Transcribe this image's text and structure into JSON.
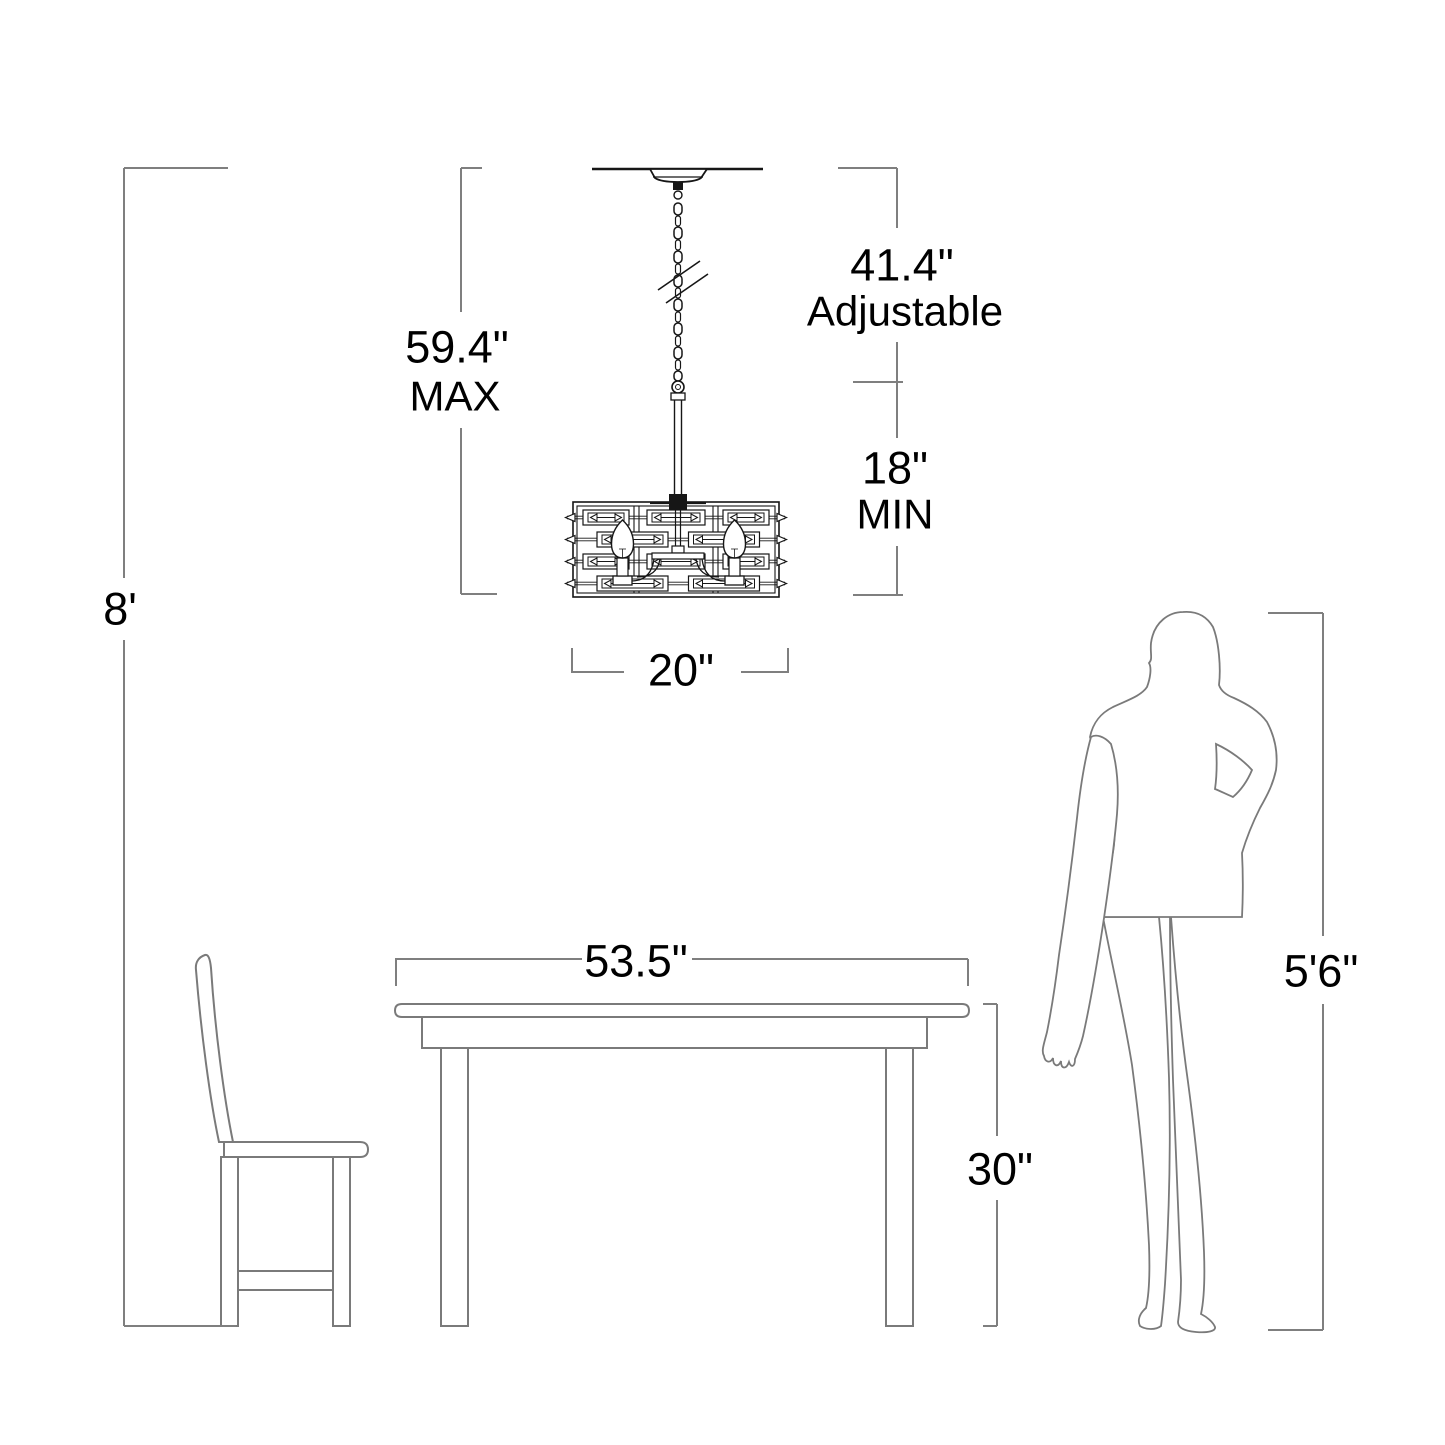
{
  "diagram": {
    "type": "lighting-fixture-dimension-diagram",
    "labels": {
      "ceiling_height": "8'",
      "max_drop_value": "59.4\"",
      "max_drop_word": "MAX",
      "adjustable_value": "41.4\"",
      "adjustable_word": "Adjustable",
      "min_drop_value": "18\"",
      "min_drop_word": "MIN",
      "fixture_width": "20\"",
      "table_width": "53.5\"",
      "table_height": "30\"",
      "person_height": "5'6\""
    },
    "measurements": {
      "ceiling_height_ft": 8,
      "fixture_max_drop_in": 59.4,
      "chain_adjustable_in": 41.4,
      "fixture_min_drop_in": 18,
      "fixture_width_in": 20,
      "table_width_in": 53.5,
      "table_height_in": 30,
      "person_height": "5'6\""
    },
    "objects": [
      "chandelier",
      "ceiling",
      "dining-table",
      "chair",
      "woman-silhouette"
    ],
    "colors": {
      "background": "#ffffff",
      "fixture_ink": "#161616",
      "dimension_lines": "#7f7f7f",
      "furniture_lines": "#7a7a7a",
      "text": "#000000"
    }
  }
}
